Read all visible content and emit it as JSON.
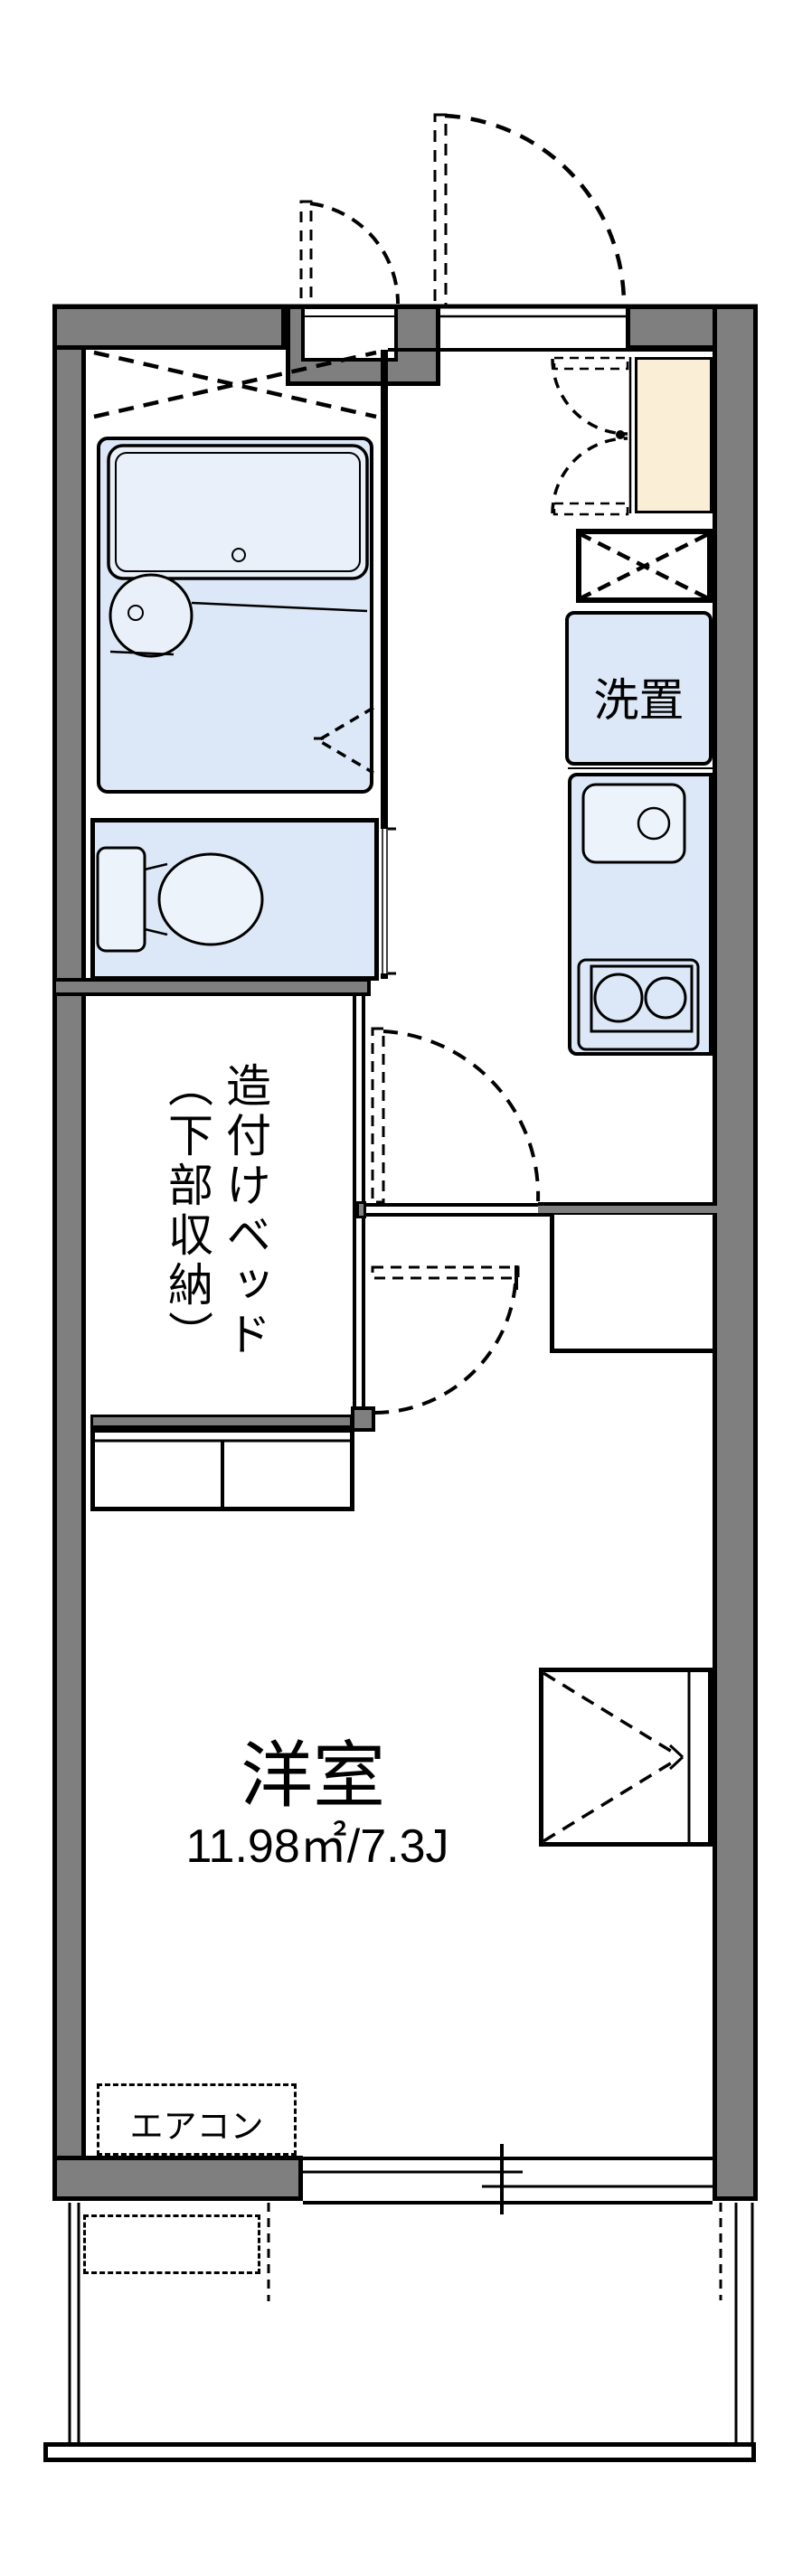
{
  "labels": {
    "laundry": "洗置",
    "bed_line1": "造付けベッド",
    "bed_line2": "（下部収納）",
    "room_name": "洋室",
    "room_area": "11.98㎡/7.3J",
    "aircon": "エアコン"
  },
  "colors": {
    "wall_gray": "#7f7f7f",
    "fixture_blue": "#dce8f7",
    "fixture_blue_light": "#edf3fb",
    "genkan_cream": "#faeed6",
    "line_black": "#000000",
    "background": "#ffffff"
  }
}
